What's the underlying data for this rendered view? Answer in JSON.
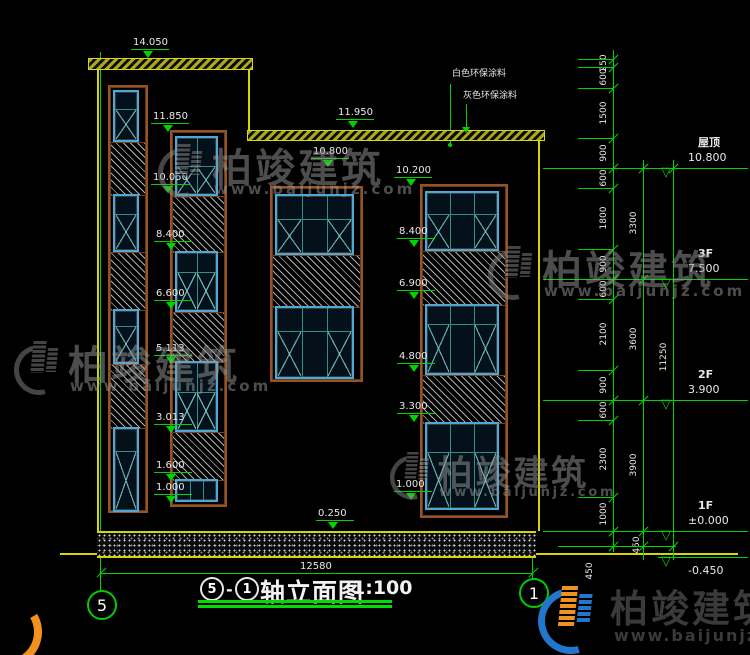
{
  "title": {
    "axis_left": "5",
    "dash": "-",
    "axis_right": "1",
    "name": "轴立面图",
    "scale": "1:100"
  },
  "overall_dim": "12580",
  "axis_bubbles": {
    "left": "5",
    "right": "1"
  },
  "annotations": {
    "white_paint": "白色环保涂料",
    "gray_paint": "灰色环保涂料"
  },
  "watermark": {
    "brand": "柏竣建筑",
    "url": "www.baijunjz.com"
  },
  "floor_marks": [
    {
      "label": "屋顶",
      "value": "10.800",
      "y": 168
    },
    {
      "label": "3F",
      "value": "7.500",
      "y": 279
    },
    {
      "label": "2F",
      "value": "3.900",
      "y": 400
    },
    {
      "label": "1F",
      "value": "±0.000",
      "y": 531
    },
    {
      "label": "",
      "value": "-0.450",
      "y": 557,
      "below": 1
    }
  ],
  "level_markers": [
    {
      "t": "14.050",
      "x": 133,
      "y": 38
    },
    {
      "t": "11.850",
      "x": 153,
      "y": 112
    },
    {
      "t": "10.050",
      "x": 153,
      "y": 173
    },
    {
      "t": "8.400",
      "x": 156,
      "y": 230
    },
    {
      "t": "6.600",
      "x": 156,
      "y": 289
    },
    {
      "t": "5.113",
      "x": 156,
      "y": 344
    },
    {
      "t": "3.013",
      "x": 156,
      "y": 413
    },
    {
      "t": "1.600",
      "x": 156,
      "y": 461
    },
    {
      "t": "1.000",
      "x": 156,
      "y": 483
    },
    {
      "t": "0.250",
      "x": 318,
      "y": 509
    },
    {
      "t": "11.950",
      "x": 338,
      "y": 108
    },
    {
      "t": "10.800",
      "x": 313,
      "y": 147
    },
    {
      "t": "10.200",
      "x": 396,
      "y": 166
    },
    {
      "t": "8.400",
      "x": 399,
      "y": 227
    },
    {
      "t": "6.900",
      "x": 399,
      "y": 279
    },
    {
      "t": "4.800",
      "x": 399,
      "y": 352
    },
    {
      "t": "3.300",
      "x": 399,
      "y": 402
    },
    {
      "t": "1.000",
      "x": 396,
      "y": 480
    }
  ],
  "dim_chains": [
    {
      "x": 613,
      "y1": 50,
      "y2": 552,
      "ticks": [
        59,
        67,
        88,
        138,
        168,
        188,
        249,
        279,
        299,
        370,
        400,
        420,
        497,
        531,
        546
      ],
      "labels": [
        {
          "t": "250",
          "y": 63
        },
        {
          "t": "600",
          "y": 77
        },
        {
          "t": "1500",
          "y": 113
        },
        {
          "t": "900",
          "y": 153
        },
        {
          "t": "600",
          "y": 178
        },
        {
          "t": "1800",
          "y": 218
        },
        {
          "t": "900",
          "y": 264
        },
        {
          "t": "600",
          "y": 289
        },
        {
          "t": "2100",
          "y": 334
        },
        {
          "t": "900",
          "y": 385
        },
        {
          "t": "600",
          "y": 410
        },
        {
          "t": "2300",
          "y": 459
        },
        {
          "t": "1000",
          "y": 514
        }
      ]
    },
    {
      "x": 643,
      "y1": 160,
      "y2": 560,
      "ticks": [
        168,
        279,
        400,
        531,
        546
      ],
      "labels": [
        {
          "t": "3300",
          "y": 223
        },
        {
          "t": "3600",
          "y": 339
        },
        {
          "t": "3900",
          "y": 465
        }
      ]
    },
    {
      "x": 673,
      "y1": 160,
      "y2": 560,
      "ticks": [
        168,
        546
      ],
      "labels": [
        {
          "t": "11250",
          "y": 357
        }
      ]
    }
  ],
  "extra_dim_labels": [
    {
      "t": "450",
      "x": 590,
      "y": 571
    },
    {
      "t": "450",
      "x": 637,
      "y": 545
    }
  ],
  "parapets": [
    {
      "x": 88,
      "y": 58,
      "w": 163,
      "h": 10
    },
    {
      "x": 247,
      "y": 130,
      "w": 296,
      "h": 9
    }
  ],
  "ground_band": {
    "x": 97,
    "y": 531,
    "w": 439,
    "h": 23
  },
  "wall_lines": [
    {
      "x": 97,
      "y": 67,
      "w": 2,
      "h": 464
    },
    {
      "x": 248,
      "y": 68,
      "w": 2,
      "h": 62
    },
    {
      "x": 538,
      "y": 139,
      "w": 2,
      "h": 392
    },
    {
      "x": 60,
      "y": 553,
      "w": 678,
      "h": 2
    }
  ],
  "green_lines": [
    {
      "x": 100,
      "y": 52,
      "w": 1,
      "h": 539
    },
    {
      "x": 532,
      "y": 538,
      "w": 1,
      "h": 41
    },
    {
      "x": 101,
      "y": 573,
      "w": 432,
      "h": 1
    },
    {
      "x": 450,
      "y": 84,
      "w": 1,
      "h": 61
    },
    {
      "x": 466,
      "y": 104,
      "w": 1,
      "h": 25
    }
  ],
  "strips": [
    {
      "x": 108,
      "w": 40,
      "y": 85,
      "h": 428,
      "items": [
        {
          "k": "w",
          "y": 3,
          "h": 52,
          "c": 1,
          "r": 17
        },
        {
          "k": "h",
          "y": 55,
          "h": 52
        },
        {
          "k": "w",
          "y": 107,
          "h": 58,
          "c": 1,
          "r": 18
        },
        {
          "k": "h",
          "y": 165,
          "h": 57
        },
        {
          "k": "w",
          "y": 222,
          "h": 55,
          "c": 1,
          "r": 15
        },
        {
          "k": "h",
          "y": 277,
          "h": 63
        },
        {
          "k": "w",
          "y": 340,
          "h": 85,
          "c": 1,
          "r": 22
        }
      ]
    },
    {
      "x": 170,
      "w": 57,
      "y": 130,
      "h": 377,
      "items": [
        {
          "k": "w",
          "y": 4,
          "h": 60,
          "c": 2,
          "r": 28
        },
        {
          "k": "h",
          "y": 64,
          "h": 55
        },
        {
          "k": "w",
          "y": 119,
          "h": 61,
          "c": 2,
          "r": 19
        },
        {
          "k": "h",
          "y": 180,
          "h": 49
        },
        {
          "k": "w",
          "y": 229,
          "h": 71,
          "c": 2,
          "r": 29
        },
        {
          "k": "h",
          "y": 300,
          "h": 47
        },
        {
          "k": "w",
          "y": 347,
          "h": 23,
          "c": 3,
          "r": 0
        }
      ]
    },
    {
      "x": 270,
      "w": 93,
      "y": 186,
      "h": 196,
      "items": [
        {
          "k": "w",
          "y": 6,
          "h": 61,
          "c": 3,
          "r": 23
        },
        {
          "k": "h",
          "y": 67,
          "h": 51
        },
        {
          "k": "w",
          "y": 118,
          "h": 73,
          "c": 3,
          "r": 23
        }
      ]
    },
    {
      "x": 420,
      "w": 88,
      "y": 184,
      "h": 334,
      "items": [
        {
          "k": "w",
          "y": 5,
          "h": 60,
          "c": 3,
          "r": 21
        },
        {
          "k": "h",
          "y": 65,
          "h": 53
        },
        {
          "k": "w",
          "y": 118,
          "h": 71,
          "c": 3,
          "r": 18
        },
        {
          "k": "h",
          "y": 189,
          "h": 47
        },
        {
          "k": "w",
          "y": 236,
          "h": 88,
          "c": 3,
          "r": 28
        }
      ]
    }
  ],
  "watermarks": [
    {
      "x": 158,
      "y": 136,
      "s": 1.0
    },
    {
      "x": 14,
      "y": 333,
      "s": 1.0
    },
    {
      "x": 488,
      "y": 238,
      "s": 1.0
    },
    {
      "x": 390,
      "y": 445,
      "s": 0.88
    }
  ],
  "colors": {
    "green": "#00d400",
    "yellow": "#d6d600",
    "blue_frame": "#4fa8d4",
    "brown": "#9a5224",
    "logo_blue": "#2277cc",
    "logo_orange": "#f2921e"
  }
}
